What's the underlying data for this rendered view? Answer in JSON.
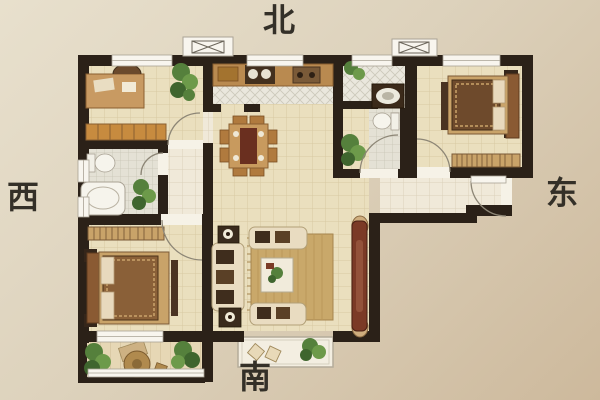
{
  "compass": {
    "north": "北",
    "south": "南",
    "west": "西",
    "east": "东"
  },
  "palette": {
    "background_top": "#e8e0cd",
    "background_bottom": "#cdb99c",
    "wall": "#2b2118",
    "floor_cream": "#eadfbe",
    "floor_grid_line": "#d8c9a2",
    "floor_tile_small": "#e4e1d5",
    "floor_diagonal_tile": "#eae7dd",
    "floor_entry_hall": "#f0e9d9",
    "balcony_floor": "#e6d7b5",
    "bay_floor": "#f3eee1",
    "window_white": "#f8f5ee",
    "wood_light": "#c49459",
    "wood_dark": "#8a5a33",
    "tv_cabinet_red": "#7b3a26",
    "sofa_cream": "#e9dcc1",
    "plant_green": "#55803c",
    "label_color": "#343028"
  },
  "rooms": [
    "study",
    "kitchen",
    "utility-area",
    "bathroom-north",
    "bedroom-east",
    "entry-hall",
    "dining-area",
    "living-room",
    "bathroom-west",
    "bedroom-master",
    "balcony-southwest",
    "south-bay"
  ],
  "icons": [
    "flue-shaft-icon",
    "door-swing-icon",
    "window-icon",
    "bed-icon",
    "sofa-icon",
    "dining-table-icon",
    "toilet-icon",
    "bathtub-icon",
    "washer-icon",
    "wardrobe-icon",
    "plant-icon",
    "tv-cabinet-icon"
  ]
}
